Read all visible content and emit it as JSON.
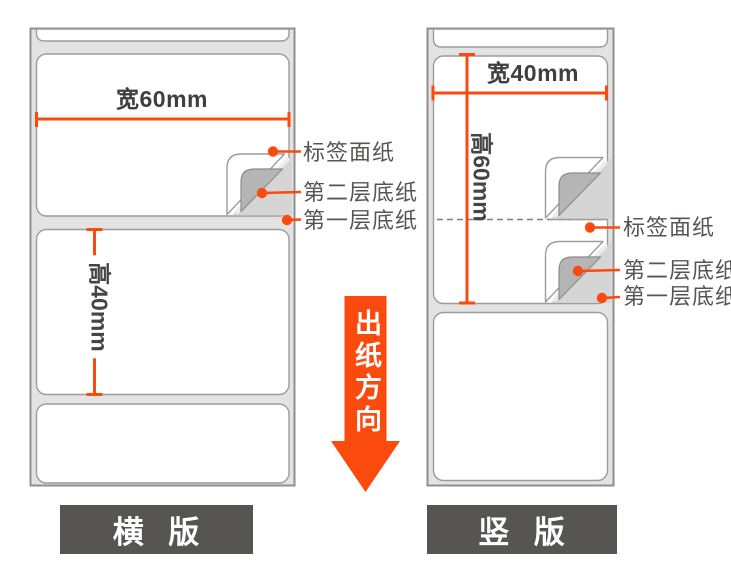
{
  "diagram_title": "label-roll-orientation-spec",
  "left_roll": {
    "orientation_caption": "横 版",
    "width_dim": "宽60mm",
    "height_dim": "高40mm",
    "callouts": {
      "face": "标签面纸",
      "liner2": "第二层底纸",
      "liner1": "第一层底纸"
    }
  },
  "right_roll": {
    "orientation_caption": "竖 版",
    "width_dim": "宽40mm",
    "height_dim": "高60mm",
    "callouts": {
      "face": "标签面纸",
      "liner2": "第二层底纸",
      "liner1": "第一层底纸"
    }
  },
  "arrow": {
    "label": "出纸方向"
  },
  "colors": {
    "accent": "#fa4a0d",
    "roll_backing": "#e3e3e3",
    "roll_border": "#8f8f8f",
    "label_border": "#9c9c9c",
    "fold_layer": "#b5b5b5",
    "revealed_liner": "#d5d5d5",
    "caption_plate": "#575454",
    "dim_text": "#3f3f3f",
    "callout_text": "#585454"
  }
}
